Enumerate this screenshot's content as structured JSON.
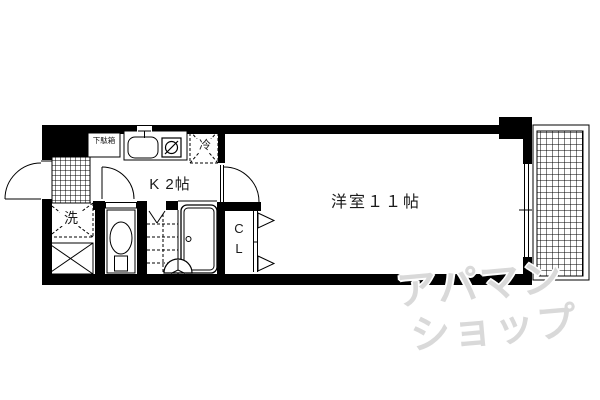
{
  "floorplan": {
    "kitchen": {
      "label": "K 2帖"
    },
    "western_room": {
      "label": "洋室１１帖"
    },
    "closet": {
      "letter_top": "C",
      "letter_bottom": "L"
    },
    "shoe_cabinet": {
      "label": "下駄箱"
    },
    "refrigerator": {
      "label": "冷"
    },
    "washing_machine": {
      "label": "洗"
    },
    "watermark": {
      "line1": "アパマン",
      "line2": "ショップ",
      "color": "#d9d9d9"
    },
    "colors": {
      "wall": "#000000",
      "background": "#ffffff",
      "line": "#000000"
    }
  }
}
